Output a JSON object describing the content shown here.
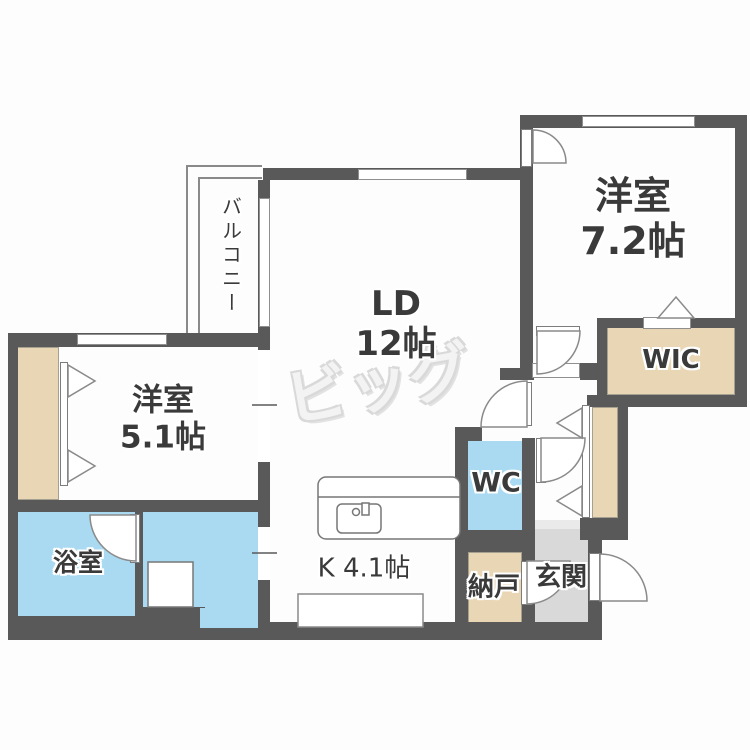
{
  "floorplan": {
    "watermark_text": "ビッグ",
    "labels": {
      "balcony": "バルコニー",
      "living_name": "LD",
      "living_size": "12帖",
      "bedroom_right_name": "洋室",
      "bedroom_right_size": "7.2帖",
      "bedroom_left_name": "洋室",
      "bedroom_left_size": "5.1帖",
      "wic": "WIC",
      "bath": "浴室",
      "kitchen": "K 4.1帖",
      "toilet": "WC",
      "storage": "納戸",
      "entrance": "玄関"
    },
    "colors": {
      "wall": "#595959",
      "closet_fill": "#e9d6b4",
      "water_area_fill": "#a9daf2",
      "entrance_fill": "#d9d9d9",
      "line": "#8a8a8a",
      "label_text": "#3a3a3a",
      "watermark": "#f3f3f3"
    }
  }
}
